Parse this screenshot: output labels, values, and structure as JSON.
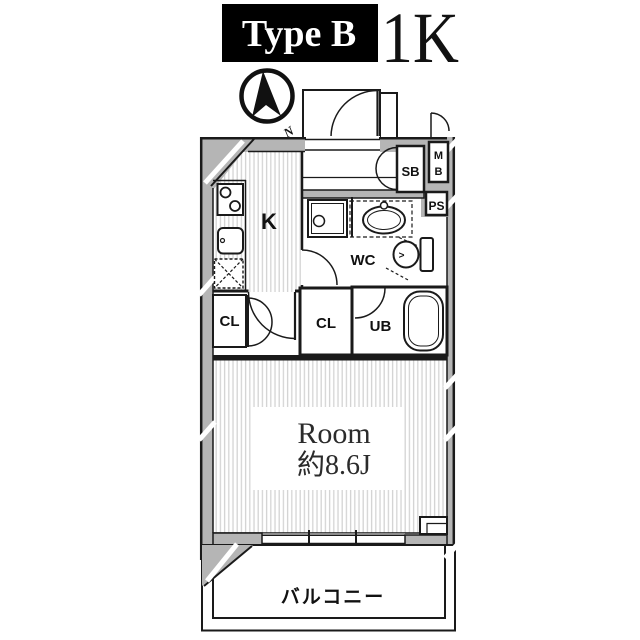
{
  "header": {
    "type_label": "Type B",
    "unit_type": "1K"
  },
  "compass": {
    "north_mark": "N"
  },
  "floorplan": {
    "labels": {
      "kitchen": "K",
      "closet_left": "CL",
      "closet_center": "CL",
      "unit_bath": "UB",
      "water_closet": "WC",
      "shoe_box": "SB",
      "meter_box_top": "M",
      "meter_box_bottom": "B",
      "pipe_space": "PS",
      "room_name": "Room",
      "room_size": "約8.6J",
      "balcony": "バルコニー",
      "toilet_mark": ">"
    },
    "colors": {
      "header_bg": "#000000",
      "wall_fill": "#b5b5b5",
      "outline": "#1a1a1a",
      "floor_stripe": "#d4d4d4",
      "room_text": "#2b2b2b"
    }
  }
}
